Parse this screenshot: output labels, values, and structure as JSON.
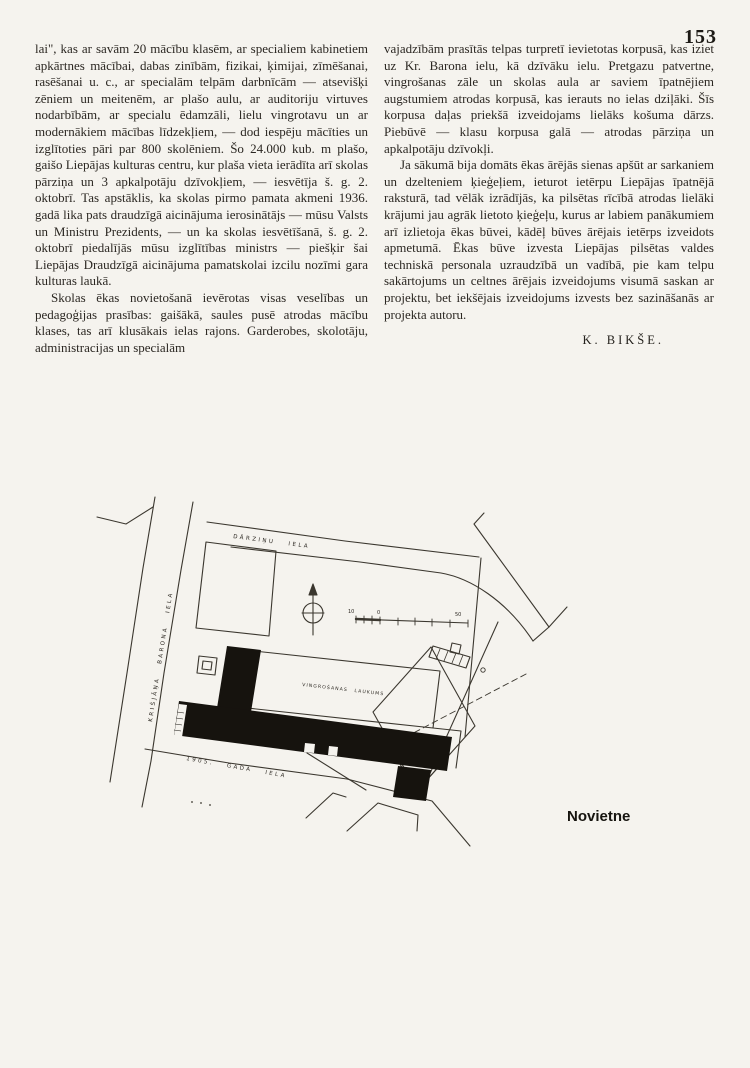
{
  "page": {
    "number": "153",
    "paper_color": "#f5f3ee",
    "ink_color": "#2b2722"
  },
  "article": {
    "left_column": {
      "para1": "lai\", kas ar savām 20 mācību klasēm, ar specialiem kabinetiem apkārtnes mācībai, dabas zinībām, fizikai, ķimijai, zīmēšanai, rasēšanai u. c., ar specialām telpām darbnīcām — atsevišķi zēniem un meitenēm, ar plašo aulu, ar auditoriju virtuves nodarbībām, ar specialu ēdamzāli, lielu vingrotavu un ar modernākiem mācības līdzekļiem, — dod iespēju mācīties un izglītoties pāri par 800 skolēniem. Šo 24.000 kub. m plašo, gaišo Liepājas kulturas centru, kur plaša vieta ierādīta arī skolas pārziņa un 3 apkalpotāju dzīvokļiem, — iesvētīja š. g. 2. oktobrī. Tas apstāklis, ka skolas pirmo pamata akmeni 1936. gadā lika pats draudzīgā aicinājuma ierosinātājs — mūsu Valsts un Ministru Prezidents, — un ka skolas iesvētīšanā, š. g. 2. oktobrī piedalījās mūsu izglītības ministrs — piešķir šai Liepājas Draudzīgā aicinājuma pamatskolai izcilu nozīmi gara kulturas laukā.",
      "para2": "Skolas ēkas novietošanā ievērotas visas veselības un pedagoģijas prasības: gaišākā, saules pusē atrodas mācību klases, tas arī klusākais ielas rajons. Garderobes, skolotāju, administracijas un specialām"
    },
    "right_column": {
      "para1": "vajadzībām prasītās telpas turpretī ievietotas korpusā, kas iziet uz Kr. Barona ielu, kā dzīvāku ielu. Pretgazu patvertne, vingrošanas zāle un skolas aula ar saviem īpatnējiem augstumiem atrodas korpusā, kas ierauts no ielas dziļāki. Šīs korpusa daļas priekšā izveidojams lielāks košuma dārzs. Piebūvē — klasu korpusa galā — atrodas pārziņa un apkalpotāju dzīvokļi.",
      "para2": "Ja sākumā bija domāts ēkas ārējās sienas apšūt ar sarkaniem un dzelteniem ķieģeļiem, ieturot ietērpu Liepājas īpatnējā raksturā, tad vēlāk izrādījās, ka pilsētas rīcībā atrodas lielāki krājumi jau agrāk lietoto ķieģeļu, kurus ar labiem panākumiem arī izlietoja ēkas būvei, kādēļ būves ārējais ietērps izveidots apmetumā. Ēkas būve izvesta Liepājas pilsētas valdes techniskā personala uzraudzībā un vadībā, pie kam telpu sakārtojums un celtnes ārējais izveidojums visumā saskan ar projektu, bet iekšējais izveidojums izvests bez sazināšanās ar projekta autoru."
    },
    "signature": "K. BIKŠE."
  },
  "site_plan": {
    "caption": "Novietne",
    "labels": {
      "street_top": "DĀRZIŅU IELA",
      "street_left": "KRIŠJĀŅA BARONA IELA",
      "street_bottom": "1905. GADA IELA",
      "field": "VINGROŠANAS LAUKUMS",
      "scale_left": "10",
      "scale_zero": "0",
      "scale_right": "50"
    },
    "colors": {
      "line_ink": "#3b372f",
      "building_fill": "#16130e"
    }
  }
}
